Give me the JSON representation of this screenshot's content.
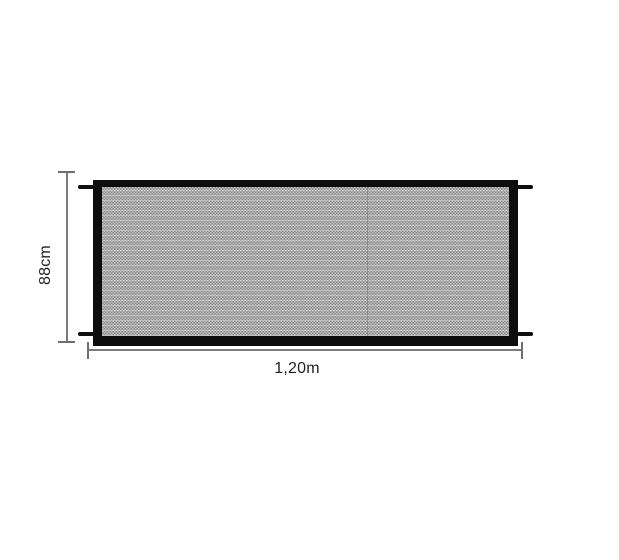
{
  "product": {
    "name": "mesh-safety-gate-dimension-diagram",
    "height_label": "88cm",
    "width_label": "1,20m"
  },
  "diagram": {
    "measurements": [
      {
        "axis": "vertical",
        "value": "88cm"
      },
      {
        "axis": "horizontal",
        "value": "1,20m"
      }
    ]
  },
  "colors": {
    "background": "#ffffff",
    "frame": "#0d0d0d",
    "mesh_dark": "#939393",
    "mesh_light": "#c9c9c9",
    "dimension_line": "#7d7d7d",
    "label_text": "#1f1f1f"
  },
  "icons": {
    "mounting_pegs": "black-hook-tabs-at-four-corners"
  }
}
